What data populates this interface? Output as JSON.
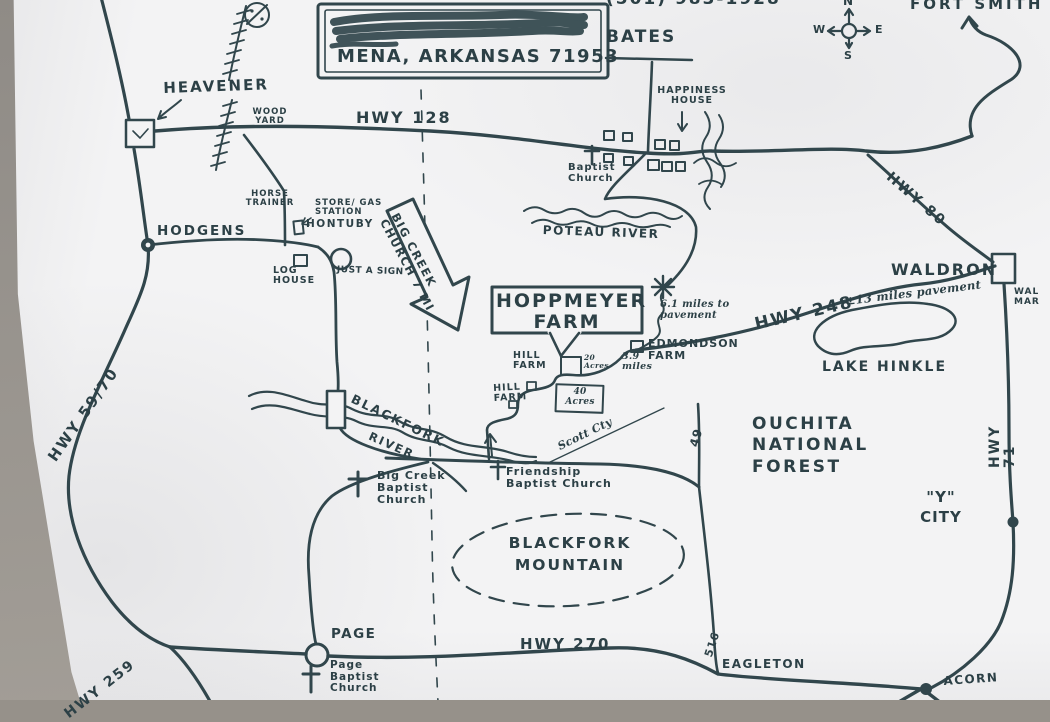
{
  "colors": {
    "ink": "#31464c",
    "text_ink": "#2c4046",
    "paper": "#f3f3f4",
    "backdrop": "#96918a"
  },
  "title_box": {
    "name_line_scribbled_out": true
  },
  "symbols": {
    "church": "cross-icon",
    "town_large": "open-square-marker",
    "town_small": "filled-dot-marker",
    "junction_star": "asterisk-star-marker",
    "railroad": "hatched-line",
    "county_line": "dashed-line"
  },
  "labels": {
    "mena_line": "MENA, ARKANSAS 71953",
    "phone_partial": "(501) 983-1928",
    "bates": "BATES",
    "fort_smith": "FORT SMITH",
    "compass_n": "N",
    "compass_e": "E",
    "compass_s": "S",
    "compass_w": "W",
    "heavener": "HEAVENER",
    "wood_yard": "WOOD YARD",
    "hwy_128": "HWY 128",
    "hwy_80": "HWY 80",
    "happiness_house": "HAPPINESS HOUSE",
    "baptist_church": "Baptist Church",
    "poteau_river": "POTEAU RIVER",
    "hodgens": "HODGENS",
    "horse_trainer": "HORSE TRAINER",
    "store_gas_station": "STORE/ GAS STATION",
    "hontuby": "HONTUBY",
    "log_house": "LOG HOUSE",
    "just_a_sign": "JUST A SIGN",
    "big_creek_arrow": "BIG CREEK\nCHURCH 7 MI",
    "hoppmeyer_farm": "HOPPMEYER FARM",
    "miles_6_1": "6.1 miles to pavement",
    "edmondson_farm": "EDMONDSON FARM",
    "miles_3_9": "3.9 miles",
    "hill_farm": "HILL FARM",
    "acres_20": "20 Acres",
    "acres_40": "40 Acres",
    "hwy_248": "HWY 248",
    "pavement_13": "±13 miles pavement",
    "waldron": "WALDRON",
    "wal_mar": "WAL MAR",
    "lake_hinkle": "LAKE HINKLE",
    "hwy_71": "HWY 71",
    "ouachita": "OUCHITA NATIONAL FOREST",
    "y_city": "\"Y\" CITY",
    "blackfork": "BLACKFORK",
    "river": "RIVER",
    "big_creek_church": "Big Creek Baptist Church",
    "friendship_church": "Friendship Baptist Church",
    "scott_cty": "Scott Cty",
    "road_49": "49",
    "road_516": "516",
    "blackfork_mountain": "BLACKFORK MOUNTAIN",
    "page": "PAGE",
    "page_church": "Page Baptist Church",
    "hwy_270": "HWY 270",
    "hwy_259": "HWY 259",
    "hwy_59_70": "HWY 59/70",
    "eagleton": "EAGLETON",
    "acorn": "ACORN"
  }
}
